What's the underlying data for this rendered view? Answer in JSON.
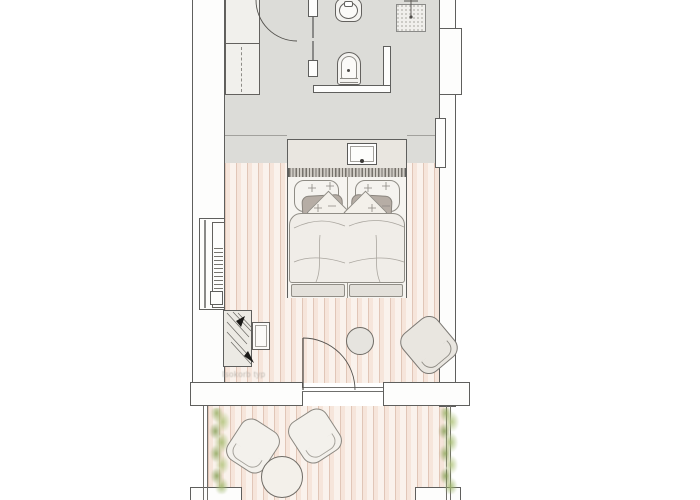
{
  "document": {
    "kind": "architectural floor plan",
    "view": "top-down hotel room plan",
    "annotation_note": "Isokorb typ"
  },
  "colors": {
    "wall_outline": "#5f5f5d",
    "bathroom_floor": "#dcdcd8",
    "wood_floor_base": "#f9f1ea",
    "wood_plank_line": "#d0ac9a",
    "furniture_fill": "#f2f0ec",
    "accent_pillow_gray": "#b6ada5",
    "headboard_fringe": "#76726b",
    "plant_green": "#a3bd77"
  },
  "rooms": [
    {
      "name": "bathroom",
      "fixtures": [
        "wardrobe",
        "entry door",
        "toilet",
        "bidet",
        "glass partition",
        "shower",
        "washbasin vanity"
      ]
    },
    {
      "name": "bedroom",
      "furniture": [
        "double bed",
        "pillows",
        "radiator",
        "fold-out desk",
        "stool",
        "side table",
        "armchair",
        "balcony door"
      ]
    },
    {
      "name": "balcony",
      "furniture": [
        "lounge chair left",
        "lounge chair right",
        "round table",
        "planter left",
        "planter right"
      ]
    }
  ]
}
